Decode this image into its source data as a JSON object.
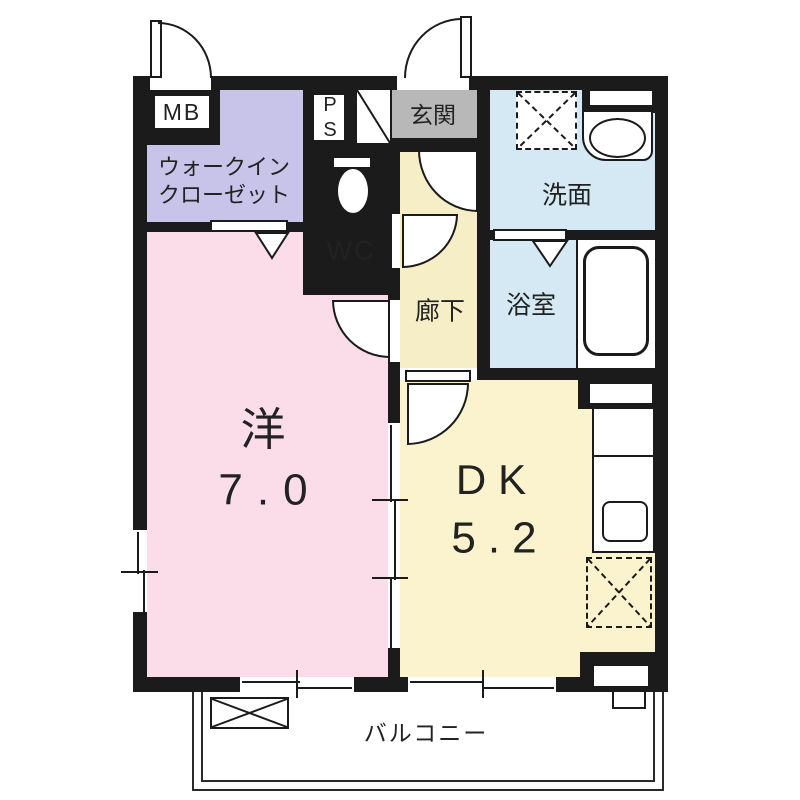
{
  "palette": {
    "wall": "#1b1b1b",
    "western_room": "#fadde8",
    "dk_hallway": "#faf3cd",
    "walk_in_closet": "#c7c3e9",
    "wet_rooms": "#d4e9f4",
    "wc": "#cde5f2",
    "entrance": "#b8b8b8",
    "background": "#ffffff"
  },
  "rooms": {
    "western": {
      "label": "洋",
      "size": "7.0"
    },
    "dk": {
      "label": "DK",
      "size": "5.2"
    },
    "wic": {
      "line1": "ウォークイン",
      "line2": "クローゼット"
    },
    "wc": {
      "label": "WC"
    },
    "washroom": {
      "label": "洗面"
    },
    "bathroom": {
      "label": "浴室"
    },
    "hallway": {
      "label": "廊下"
    },
    "entrance": {
      "label": "玄関"
    },
    "meter_box": {
      "label": "MB"
    },
    "pipe_space": {
      "line1": "P",
      "line2": "S"
    },
    "balcony": {
      "label": "バルコニー"
    }
  }
}
